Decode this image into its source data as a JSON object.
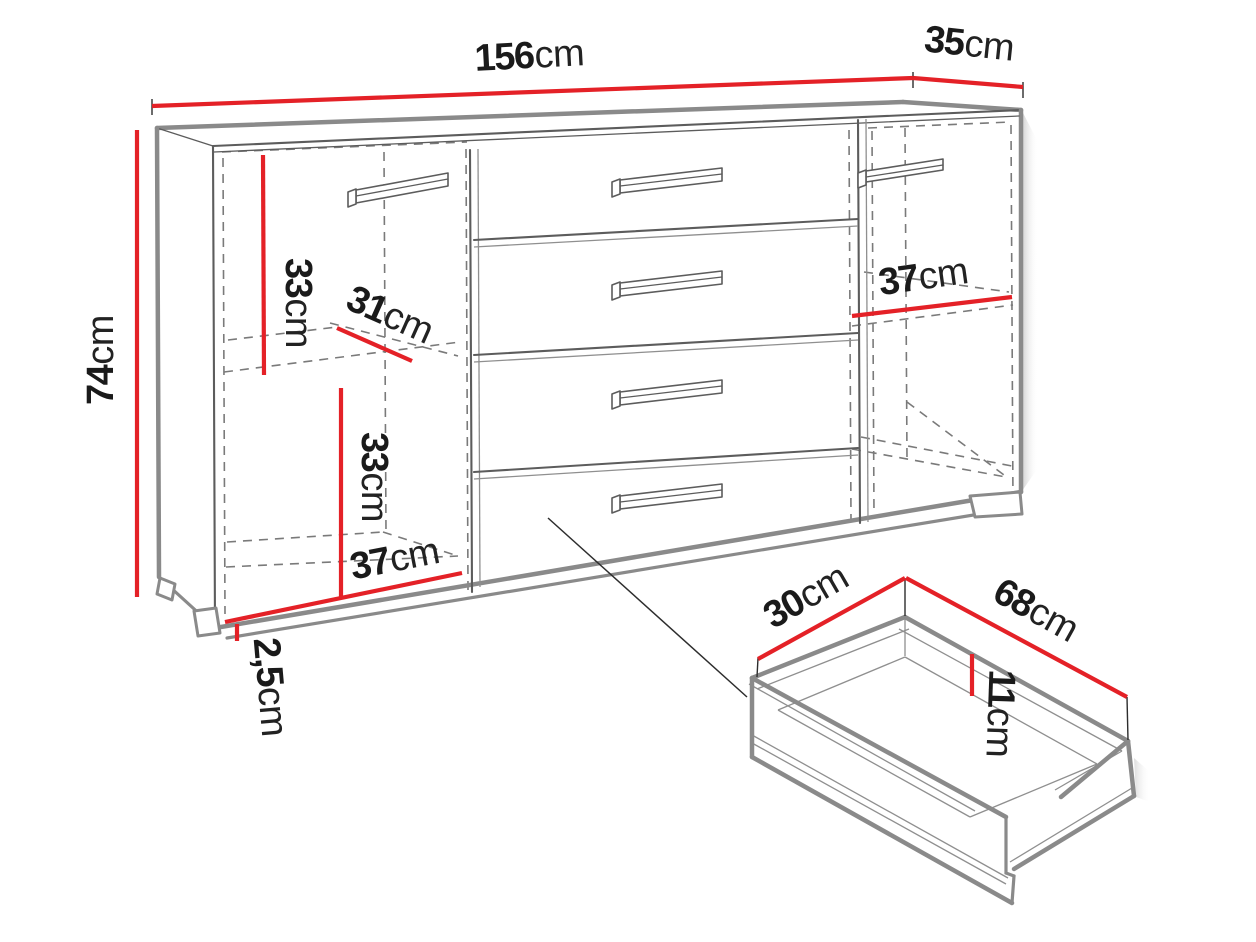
{
  "diagram": {
    "kind": "furniture-dimension-drawing",
    "subject": "sideboard with two doors, four drawers and a detail view of one drawer",
    "colors": {
      "dimension": "#e42127",
      "outline": "#8a8a8a",
      "detail": "#5c5c5c",
      "dashed": "#7a7a7a",
      "text": "#1a1a1a",
      "background": "#ffffff"
    }
  },
  "labels": {
    "cabinet_width": {
      "value": "156",
      "unit": "cm"
    },
    "cabinet_depth": {
      "value": "35",
      "unit": "cm"
    },
    "cabinet_height": {
      "value": "74",
      "unit": "cm"
    },
    "left_upper_compartment_height": {
      "value": "33",
      "unit": "cm"
    },
    "shelf_depth": {
      "value": "31",
      "unit": "cm"
    },
    "left_lower_compartment_height": {
      "value": "33",
      "unit": "cm"
    },
    "left_compartment_width": {
      "value": "37",
      "unit": "cm"
    },
    "plinth_height": {
      "value": "2,5",
      "unit": "cm"
    },
    "right_compartment_width": {
      "value": "37",
      "unit": "cm"
    },
    "drawer_depth": {
      "value": "30",
      "unit": "cm"
    },
    "drawer_width": {
      "value": "68",
      "unit": "cm"
    },
    "drawer_inner_height": {
      "value": "11",
      "unit": "cm"
    }
  }
}
